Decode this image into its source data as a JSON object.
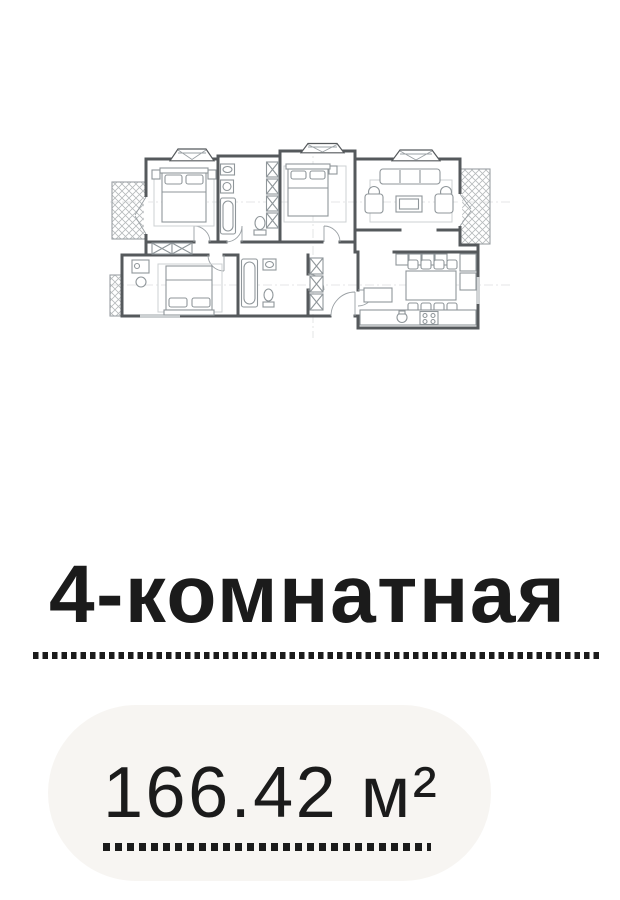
{
  "listing": {
    "title": "4-комнатная",
    "area_value": "166.42 м²"
  },
  "floorplan": {
    "alt": "floor-plan-drawing",
    "type": "architectural plan, 4-room apartment with two hatched balconies"
  },
  "colors": {
    "page_background": "#ffffff",
    "heading_text": "#1b1b1b",
    "area_text": "#1b1b1b",
    "dot_color": "#1b1b1b",
    "card_background": "#f7f5f2",
    "plan_wall": "#55595c",
    "plan_furniture": "#8f969a",
    "plan_hatch": "#b6babc"
  }
}
